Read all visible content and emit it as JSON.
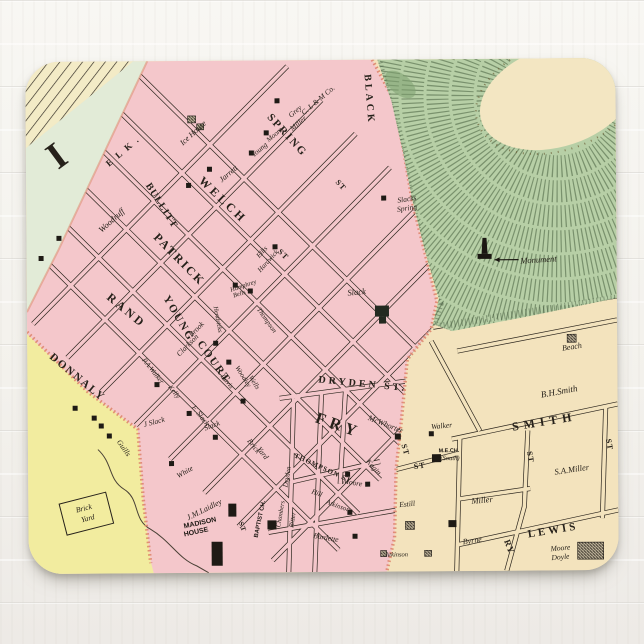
{
  "palette": {
    "wood_white": "#f6f4f0",
    "block_pink": "#f4c7cb",
    "block_tan": "#f3e3bd",
    "block_yellow": "#f2ec9f",
    "river_green": "#e2ebd7",
    "hill_green": "#b7cfa6",
    "hill_hachure": "#47603e",
    "summit_cream": "#f3e6c2",
    "ink": "#26211a",
    "boundary_salmon": "#dd8168"
  },
  "map": {
    "labels": [
      {
        "n": "elk-street",
        "t": "E L K .",
        "x": 99,
        "y": 92,
        "r": -40,
        "fs": 9,
        "s": "street",
        "ls": 2
      },
      {
        "n": "spring-street",
        "t": "SPRING",
        "x": 259,
        "y": 77,
        "r": 48,
        "fs": 11,
        "s": "street",
        "ls": 2
      },
      {
        "n": "spring-street-st",
        "t": "ST",
        "x": 313,
        "y": 127,
        "r": 48,
        "fs": 8,
        "s": "street",
        "ls": 1
      },
      {
        "n": "black-street",
        "t": "BLACK",
        "x": 341,
        "y": 40,
        "r": 86,
        "fs": 10,
        "s": "street",
        "ls": 3
      },
      {
        "n": "welch-street",
        "t": "WELCH",
        "x": 194,
        "y": 142,
        "r": 44,
        "fs": 12,
        "s": "street",
        "ls": 3
      },
      {
        "n": "bullitt-street",
        "t": "BULLITT",
        "x": 133,
        "y": 146,
        "r": 58,
        "fs": 10,
        "s": "street",
        "ls": 1
      },
      {
        "n": "patrick-street",
        "t": "PATRICK",
        "x": 150,
        "y": 201,
        "r": 46,
        "fs": 12,
        "s": "street",
        "ls": 2
      },
      {
        "n": "rand-street",
        "t": "RAND",
        "x": 97,
        "y": 252,
        "r": 40,
        "fs": 12,
        "s": "street",
        "ls": 3
      },
      {
        "n": "young-street",
        "t": "YOUNG",
        "x": 149,
        "y": 259,
        "r": 60,
        "fs": 11,
        "s": "street",
        "ls": 2
      },
      {
        "n": "court-street",
        "t": "COURT",
        "x": 184,
        "y": 303,
        "r": 55,
        "fs": 11,
        "s": "street",
        "ls": 2
      },
      {
        "n": "court-street-st",
        "t": "ST",
        "x": 375,
        "y": 391,
        "r": 75,
        "fs": 8,
        "s": "street",
        "ls": 1
      },
      {
        "n": "donnaly-street",
        "t": "DONNALY",
        "x": 48,
        "y": 318,
        "r": 40,
        "fs": 11,
        "s": "street",
        "ls": 2
      },
      {
        "n": "dryden-street",
        "t": "DRYDEN ST.",
        "x": 335,
        "y": 327,
        "r": 6,
        "fs": 10,
        "s": "street",
        "ls": 3
      },
      {
        "n": "fry-street",
        "t": "FRY",
        "x": 309,
        "y": 370,
        "r": 20,
        "fs": 16,
        "s": "street",
        "ls": 5
      },
      {
        "n": "thompson-street",
        "t": "THOMPSON ST",
        "x": 294,
        "y": 410,
        "r": 25,
        "fs": 7,
        "s": "street",
        "ls": 1
      },
      {
        "n": "smith-street",
        "t": "SMITH",
        "x": 517,
        "y": 367,
        "r": -9,
        "fs": 12,
        "s": "street",
        "ls": 5
      },
      {
        "n": "lewis-street",
        "t": "LEWIS",
        "x": 525,
        "y": 475,
        "r": -9,
        "fs": 11,
        "s": "street",
        "ls": 3
      },
      {
        "n": "ry-street",
        "t": "RY",
        "x": 478,
        "y": 489,
        "r": 70,
        "fs": 9,
        "s": "street",
        "ls": 1
      },
      {
        "n": "st-vertical-smith",
        "t": "ST",
        "x": 500,
        "y": 399,
        "r": 80,
        "fs": 8,
        "s": "street",
        "ls": 1
      },
      {
        "n": "st-vertical-right",
        "t": "ST",
        "x": 579,
        "y": 387,
        "r": 80,
        "fs": 8,
        "s": "street",
        "ls": 1
      },
      {
        "n": "st-mech",
        "t": "ST",
        "x": 392,
        "y": 409,
        "r": -8,
        "fs": 8,
        "s": "street",
        "ls": 1
      },
      {
        "n": "st-small-court",
        "t": "ST",
        "x": 255,
        "y": 196,
        "r": 45,
        "fs": 8,
        "s": "street",
        "ls": 1
      },
      {
        "n": "st-madison",
        "t": "ST",
        "x": 212,
        "y": 467,
        "r": 70,
        "fs": 7,
        "s": "street",
        "ls": 1
      },
      {
        "n": "district-numeral",
        "t": "I",
        "x": 38,
        "y": 104,
        "r": -36,
        "fs": 38,
        "s": "street",
        "ls": 0
      },
      {
        "n": "ice-house",
        "t": "Ice House",
        "x": 169,
        "y": 74,
        "r": -42,
        "fs": 8,
        "s": "name"
      },
      {
        "n": "clm-co",
        "t": "C. L & M Co.",
        "x": 294,
        "y": 42,
        "r": -40,
        "fs": 7.5,
        "s": "name"
      },
      {
        "n": "grey",
        "t": "Grey",
        "x": 271,
        "y": 53,
        "r": -40,
        "fs": 7.5,
        "s": "name"
      },
      {
        "n": "miller-top",
        "t": "Miller",
        "x": 274,
        "y": 65,
        "r": -40,
        "fs": 7.5,
        "s": "name"
      },
      {
        "n": "moore-top",
        "t": "Moore",
        "x": 250,
        "y": 76,
        "r": -40,
        "fs": 7,
        "s": "name"
      },
      {
        "n": "young-top",
        "t": "Young",
        "x": 235,
        "y": 91,
        "r": -40,
        "fs": 7.5,
        "s": "name"
      },
      {
        "n": "jarrett",
        "t": "Jarrett",
        "x": 204,
        "y": 115,
        "r": -40,
        "fs": 8,
        "s": "name"
      },
      {
        "n": "woodruff",
        "t": "Woodruff",
        "x": 87,
        "y": 161,
        "r": -42,
        "fs": 8.5,
        "s": "name"
      },
      {
        "n": "ellis",
        "t": "Ellis",
        "x": 237,
        "y": 193,
        "r": -48,
        "fs": 7,
        "s": "name"
      },
      {
        "n": "hardwick",
        "t": "Hardwick",
        "x": 243,
        "y": 202,
        "r": -48,
        "fs": 7,
        "s": "name"
      },
      {
        "n": "humphrey",
        "t": "Humphrey",
        "x": 217,
        "y": 227,
        "r": -18,
        "fs": 6.5,
        "s": "name"
      },
      {
        "n": "bells",
        "t": "Bells",
        "x": 213,
        "y": 235,
        "r": -18,
        "fs": 6.5,
        "s": "name"
      },
      {
        "n": "thompson-name",
        "t": "Thompson",
        "x": 238,
        "y": 261,
        "r": 55,
        "fs": 7,
        "s": "name"
      },
      {
        "n": "hendricks",
        "t": "Hendricks",
        "x": 189,
        "y": 259,
        "r": 80,
        "fs": 6.5,
        "s": "name"
      },
      {
        "n": "brook",
        "t": "Brook",
        "x": 171,
        "y": 270,
        "r": -45,
        "fs": 7.5,
        "s": "name"
      },
      {
        "n": "clarkson",
        "t": "Clarkson",
        "x": 162,
        "y": 286,
        "r": -45,
        "fs": 7.5,
        "s": "name"
      },
      {
        "n": "woodley",
        "t": "Woodley",
        "x": 214,
        "y": 317,
        "r": 58,
        "fs": 7,
        "s": "name"
      },
      {
        "n": "wells",
        "t": "Wells",
        "x": 225,
        "y": 323,
        "r": 58,
        "fs": 7,
        "s": "name"
      },
      {
        "n": "davis",
        "t": "Davis",
        "x": 198,
        "y": 322,
        "r": 52,
        "fs": 7,
        "s": "name"
      },
      {
        "n": "pa-walker",
        "t": "P.A.Walker",
        "x": 124,
        "y": 311,
        "r": 52,
        "fs": 7,
        "s": "name"
      },
      {
        "n": "kelly",
        "t": "Kelly",
        "x": 145,
        "y": 332,
        "r": 52,
        "fs": 7,
        "s": "name"
      },
      {
        "n": "guills",
        "t": "Guills",
        "x": 94,
        "y": 388,
        "r": 55,
        "fs": 7.5,
        "s": "name"
      },
      {
        "n": "f-slack",
        "t": "F. Slack",
        "x": 171,
        "y": 356,
        "r": 52,
        "fs": 7.5,
        "s": "name"
      },
      {
        "n": "j-slack",
        "t": "J Slack",
        "x": 127,
        "y": 363,
        "r": -15,
        "fs": 7.5,
        "s": "name"
      },
      {
        "n": "slack-hill",
        "t": "Slack",
        "x": 330,
        "y": 235,
        "r": -5,
        "fs": 8.5,
        "s": "name"
      },
      {
        "n": "slack-small",
        "t": "Slack",
        "x": 185,
        "y": 367,
        "r": -20,
        "fs": 7.5,
        "s": "name"
      },
      {
        "n": "slacks-spring-1",
        "t": "Slacks",
        "x": 381,
        "y": 142,
        "r": -8,
        "fs": 7.5,
        "s": "name"
      },
      {
        "n": "slacks-spring-2",
        "t": "Spring",
        "x": 381,
        "y": 151,
        "r": -8,
        "fs": 7.5,
        "s": "name"
      },
      {
        "n": "monument",
        "t": "Monument",
        "x": 512,
        "y": 204,
        "r": -3,
        "fs": 8.5,
        "s": "name"
      },
      {
        "n": "brick-yard-pink-1",
        "t": "Brick",
        "x": 224,
        "y": 387,
        "r": 52,
        "fs": 7.5,
        "s": "name"
      },
      {
        "n": "brick-yard-pink-2",
        "t": "Yard",
        "x": 233,
        "y": 394,
        "r": 52,
        "fs": 7.5,
        "s": "name"
      },
      {
        "n": "brick-yard-box-1",
        "t": "Brick",
        "x": 56,
        "y": 449,
        "r": -14,
        "fs": 7.5,
        "s": "name"
      },
      {
        "n": "brick-yard-box-2",
        "t": "Yard",
        "x": 60,
        "y": 459,
        "r": -14,
        "fs": 7.5,
        "s": "name"
      },
      {
        "n": "white",
        "t": "White",
        "x": 158,
        "y": 413,
        "r": -30,
        "fs": 7.5,
        "s": "name"
      },
      {
        "n": "jm-laidley",
        "t": "J.M.Laidley",
        "x": 177,
        "y": 451,
        "r": -26,
        "fs": 8,
        "s": "name"
      },
      {
        "n": "madison-house-1",
        "t": "MADISON",
        "x": 172,
        "y": 464,
        "r": -12,
        "fs": 7,
        "s": "bold"
      },
      {
        "n": "madison-house-2",
        "t": "HOUSE",
        "x": 168,
        "y": 473,
        "r": -12,
        "fs": 7,
        "s": "bold"
      },
      {
        "n": "baptist-church",
        "t": "BAPTIST CH.",
        "x": 233,
        "y": 459,
        "r": -78,
        "fs": 6,
        "s": "bold"
      },
      {
        "n": "chambers",
        "t": "Chambers",
        "x": 254,
        "y": 454,
        "r": -80,
        "fs": 6.5,
        "s": "name"
      },
      {
        "n": "ritter",
        "t": "Ritter",
        "x": 266,
        "y": 460,
        "r": -80,
        "fs": 7,
        "s": "name"
      },
      {
        "n": "dryden-name",
        "t": "Dryden",
        "x": 261,
        "y": 417,
        "r": -80,
        "fs": 7,
        "s": "name"
      },
      {
        "n": "mcwhorter",
        "t": "McWhorter",
        "x": 357,
        "y": 367,
        "r": 22,
        "fs": 8,
        "s": "name"
      },
      {
        "n": "kagin",
        "t": "Kagin",
        "x": 344,
        "y": 409,
        "r": 48,
        "fs": 7.5,
        "s": "name"
      },
      {
        "n": "moore-mid",
        "t": "Moore",
        "x": 324,
        "y": 425,
        "r": 10,
        "fs": 7.5,
        "s": "name"
      },
      {
        "n": "hill-name",
        "t": "Hill",
        "x": 288,
        "y": 435,
        "r": 20,
        "fs": 7,
        "s": "name"
      },
      {
        "n": "atkinson",
        "t": "Atkinson",
        "x": 309,
        "y": 448,
        "r": 20,
        "fs": 7,
        "s": "name"
      },
      {
        "n": "burdette",
        "t": "Burdette",
        "x": 297,
        "y": 480,
        "r": 10,
        "fs": 7.5,
        "s": "name"
      },
      {
        "n": "beach",
        "t": "Beach",
        "x": 545,
        "y": 291,
        "r": -8,
        "fs": 8,
        "s": "name"
      },
      {
        "n": "bh-smith",
        "t": "B.H.Smith",
        "x": 532,
        "y": 336,
        "r": -10,
        "fs": 9,
        "s": "name"
      },
      {
        "n": "walker",
        "t": "Walker",
        "x": 414,
        "y": 369,
        "r": -5,
        "fs": 7.5,
        "s": "name"
      },
      {
        "n": "me-church",
        "t": "M.E.CH.",
        "x": 421,
        "y": 393,
        "r": 0,
        "fs": 5.5,
        "s": "bold"
      },
      {
        "n": "me-church-south",
        "t": "(South)",
        "x": 422,
        "y": 401,
        "r": 0,
        "fs": 6.5,
        "s": "name"
      },
      {
        "n": "sa-miller",
        "t": "S.A.Miller",
        "x": 544,
        "y": 414,
        "r": -8,
        "fs": 8.5,
        "s": "name"
      },
      {
        "n": "miller",
        "t": "Miller",
        "x": 454,
        "y": 444,
        "r": -5,
        "fs": 8.5,
        "s": "name"
      },
      {
        "n": "estill",
        "t": "Estill",
        "x": 379,
        "y": 447,
        "r": -5,
        "fs": 7.5,
        "s": "name"
      },
      {
        "n": "byrne",
        "t": "Byrne",
        "x": 444,
        "y": 484,
        "r": -8,
        "fs": 8,
        "s": "name"
      },
      {
        "n": "moore-doyle-1",
        "t": "Moore",
        "x": 532,
        "y": 492,
        "r": -5,
        "fs": 7.5,
        "s": "name"
      },
      {
        "n": "moore-doyle-2",
        "t": "Doyle",
        "x": 532,
        "y": 501,
        "r": -5,
        "fs": 7.5,
        "s": "name"
      },
      {
        "n": "atkinson-bottom",
        "t": "Atkinson",
        "x": 368,
        "y": 497,
        "r": 0,
        "fs": 6.5,
        "s": "name"
      }
    ],
    "buildings": [
      {
        "x": 162,
        "y": 55,
        "w": 8,
        "h": 7,
        "t": "h"
      },
      {
        "x": 171,
        "y": 63,
        "w": 7,
        "h": 6,
        "t": "h"
      },
      {
        "x": 249,
        "y": 38,
        "w": 5,
        "h": 5,
        "t": "s"
      },
      {
        "x": 238,
        "y": 70,
        "w": 5,
        "h": 5,
        "t": "s"
      },
      {
        "x": 223,
        "y": 90,
        "w": 5,
        "h": 5,
        "t": "s"
      },
      {
        "x": 181,
        "y": 106,
        "w": 5,
        "h": 5,
        "t": "s"
      },
      {
        "x": 160,
        "y": 122,
        "w": 5,
        "h": 5,
        "t": "s"
      },
      {
        "x": 30,
        "y": 174,
        "w": 5,
        "h": 5,
        "t": "s"
      },
      {
        "x": 12,
        "y": 194,
        "w": 5,
        "h": 5,
        "t": "s"
      },
      {
        "x": 246,
        "y": 184,
        "w": 5,
        "h": 5,
        "t": "s"
      },
      {
        "x": 206,
        "y": 222,
        "w": 5,
        "h": 5,
        "t": "s"
      },
      {
        "x": 221,
        "y": 228,
        "w": 5,
        "h": 5,
        "t": "s"
      },
      {
        "x": 186,
        "y": 280,
        "w": 5,
        "h": 5,
        "t": "s"
      },
      {
        "x": 199,
        "y": 299,
        "w": 5,
        "h": 5,
        "t": "s"
      },
      {
        "x": 213,
        "y": 338,
        "w": 5,
        "h": 5,
        "t": "s"
      },
      {
        "x": 127,
        "y": 321,
        "w": 5,
        "h": 5,
        "t": "s"
      },
      {
        "x": 159,
        "y": 350,
        "w": 5,
        "h": 5,
        "t": "s"
      },
      {
        "x": 185,
        "y": 374,
        "w": 5,
        "h": 5,
        "t": "s"
      },
      {
        "x": 64,
        "y": 354,
        "w": 5,
        "h": 5,
        "t": "s"
      },
      {
        "x": 71,
        "y": 362,
        "w": 5,
        "h": 5,
        "t": "s"
      },
      {
        "x": 79,
        "y": 372,
        "w": 5,
        "h": 5,
        "t": "s"
      },
      {
        "x": 45,
        "y": 344,
        "w": 5,
        "h": 5,
        "t": "s"
      },
      {
        "x": 141,
        "y": 400,
        "w": 5,
        "h": 5,
        "t": "s"
      },
      {
        "x": 355,
        "y": 136,
        "w": 5,
        "h": 5,
        "t": "s"
      },
      {
        "x": 348,
        "y": 246,
        "w": 14,
        "h": 11,
        "t": "d"
      },
      {
        "x": 352,
        "y": 257,
        "w": 7,
        "h": 7,
        "t": "d"
      },
      {
        "x": 367,
        "y": 374,
        "w": 6,
        "h": 6,
        "t": "s"
      },
      {
        "x": 317,
        "y": 412,
        "w": 5,
        "h": 5,
        "t": "s"
      },
      {
        "x": 337,
        "y": 422,
        "w": 5,
        "h": 5,
        "t": "s"
      },
      {
        "x": 319,
        "y": 450,
        "w": 5,
        "h": 5,
        "t": "s"
      },
      {
        "x": 324,
        "y": 474,
        "w": 5,
        "h": 5,
        "t": "s"
      },
      {
        "x": 200,
        "y": 443,
        "w": 8,
        "h": 13,
        "t": "s"
      },
      {
        "x": 183,
        "y": 481,
        "w": 11,
        "h": 24,
        "t": "s"
      },
      {
        "x": 239,
        "y": 460,
        "w": 9,
        "h": 9,
        "t": "s"
      },
      {
        "x": 401,
        "y": 372,
        "w": 5,
        "h": 5,
        "t": "s"
      },
      {
        "x": 404,
        "y": 395,
        "w": 9,
        "h": 8,
        "t": "s"
      },
      {
        "x": 540,
        "y": 276,
        "w": 9,
        "h": 8,
        "t": "h"
      },
      {
        "x": 377,
        "y": 462,
        "w": 9,
        "h": 8,
        "t": "h"
      },
      {
        "x": 549,
        "y": 484,
        "w": 26,
        "h": 17,
        "t": "h"
      },
      {
        "x": 352,
        "y": 491,
        "w": 6,
        "h": 6,
        "t": "h"
      },
      {
        "x": 396,
        "y": 491,
        "w": 7,
        "h": 6,
        "t": "h"
      },
      {
        "x": 420,
        "y": 461,
        "w": 8,
        "h": 7,
        "t": "s"
      }
    ]
  }
}
